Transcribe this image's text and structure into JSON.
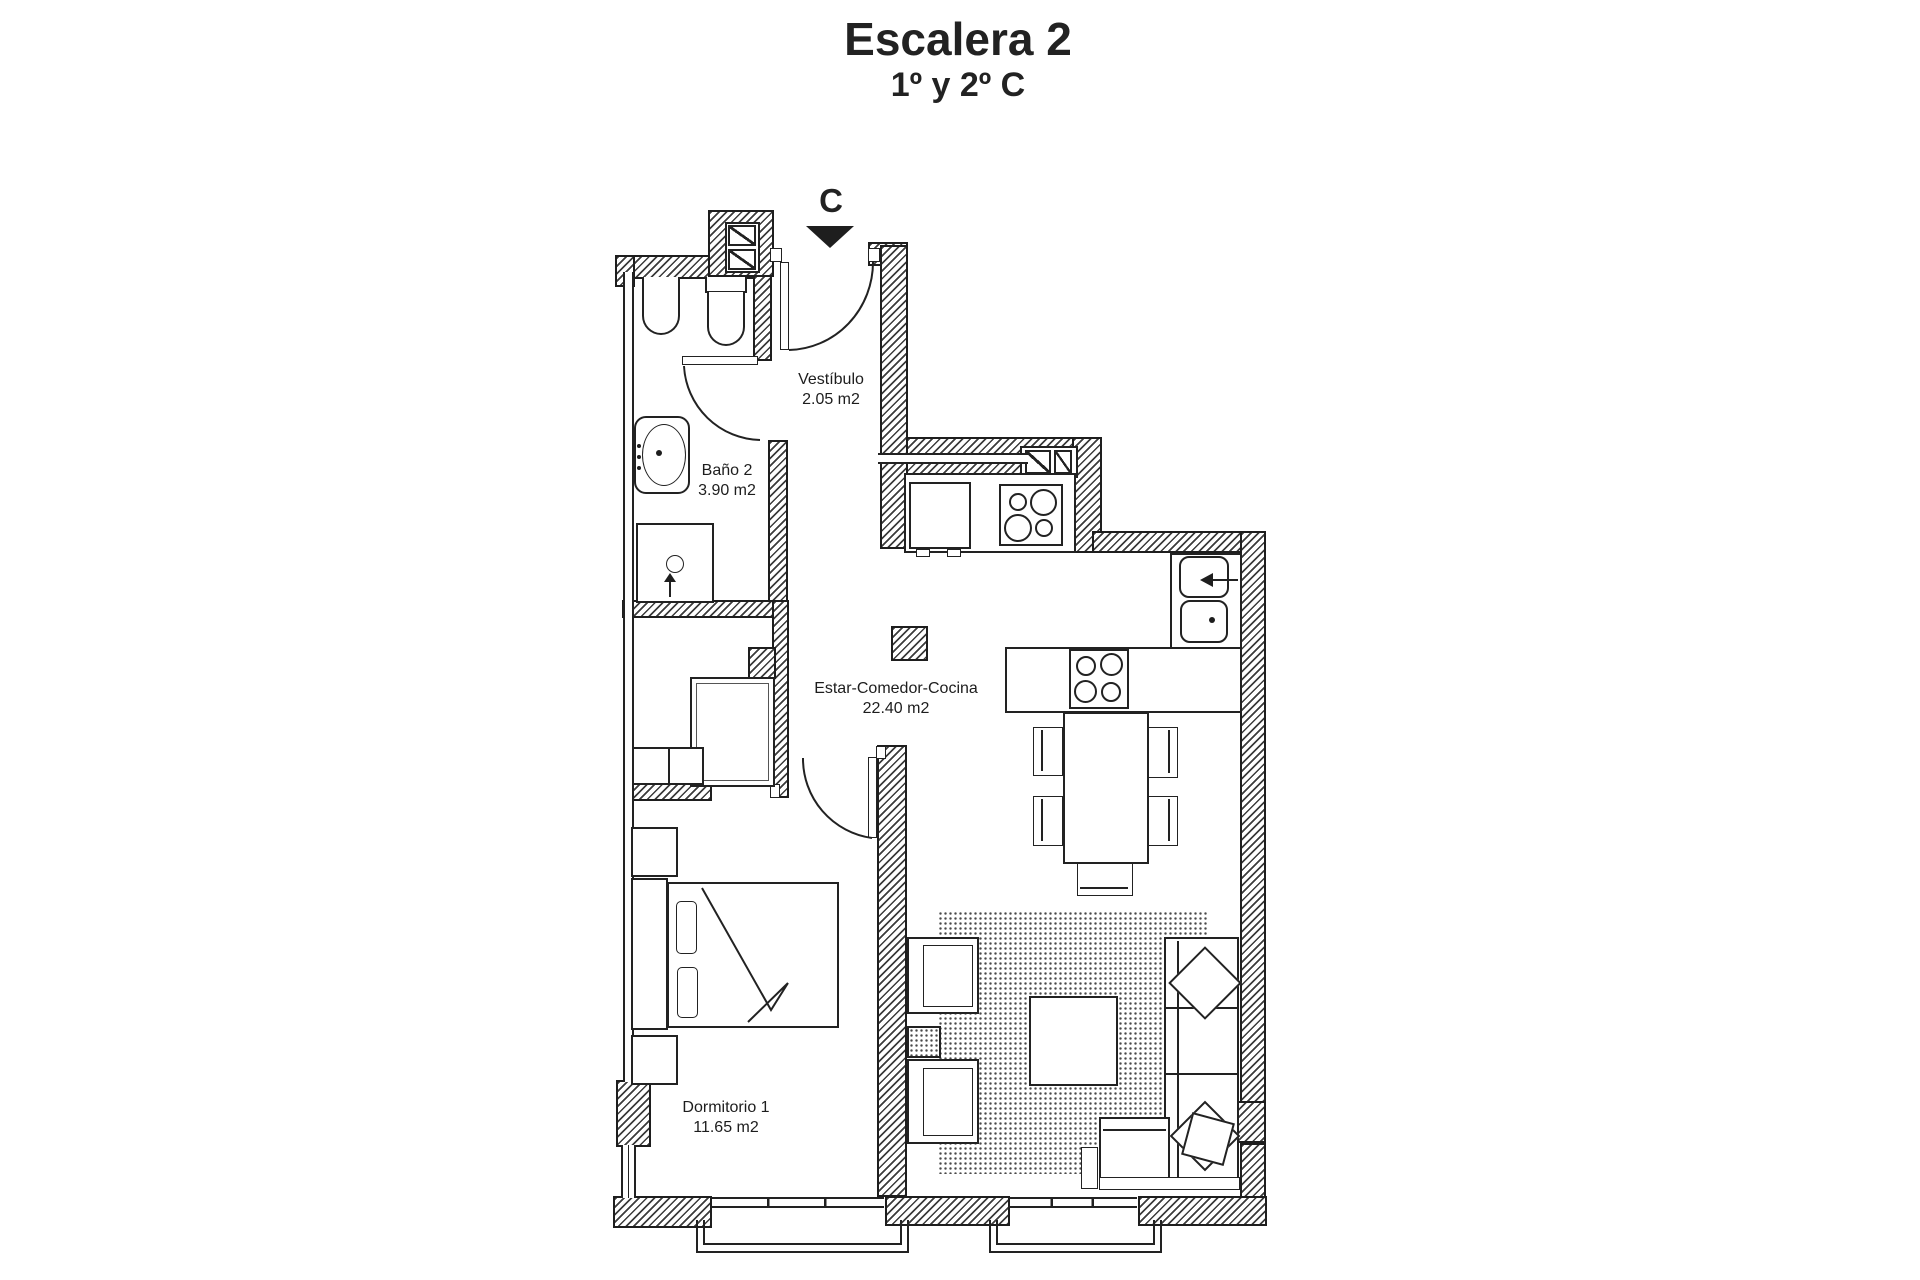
{
  "header": {
    "title": "Escalera 2",
    "subtitle": "1º y 2º C"
  },
  "entrance": {
    "marker": "C"
  },
  "rooms": {
    "vestibulo": {
      "name": "Vestíbulo",
      "area": "2.05 m2"
    },
    "bano2": {
      "name": "Baño 2",
      "area": "3.90 m2"
    },
    "estar": {
      "name": "Estar-Comedor-Cocina",
      "area": "22.40 m2"
    },
    "dormitorio1": {
      "name": "Dormitorio 1",
      "area": "11.65 m2"
    }
  },
  "colors": {
    "ink": "#1e1e1e",
    "paper": "#ffffff"
  }
}
